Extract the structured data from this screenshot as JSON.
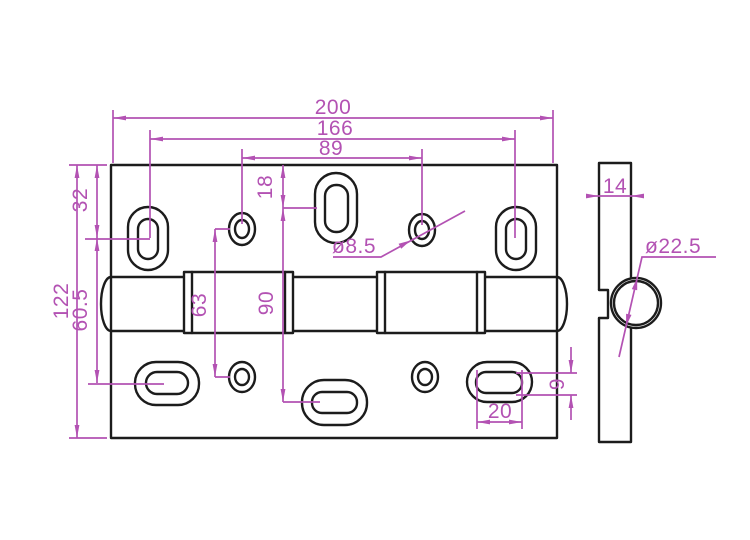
{
  "colors": {
    "background": "#ffffff",
    "outline": "#1c1c1c",
    "dimension": "#b352b3"
  },
  "front_view": {
    "dims": {
      "overall_width": "200",
      "outer_slot_span": "166",
      "hole_span": "89",
      "overall_height": "122",
      "top_slot_offset": "32",
      "bottom_slot_offset": "60.5",
      "hole_pitch": "63",
      "center_slot_pitch": "90",
      "center_slot_offset": "18",
      "hole_diameter": "ø8.5",
      "slot_length": "20",
      "slot_height": "9"
    }
  },
  "side_view": {
    "dims": {
      "leaf_thickness": "14",
      "knuckle_diameter": "ø22.5"
    }
  }
}
